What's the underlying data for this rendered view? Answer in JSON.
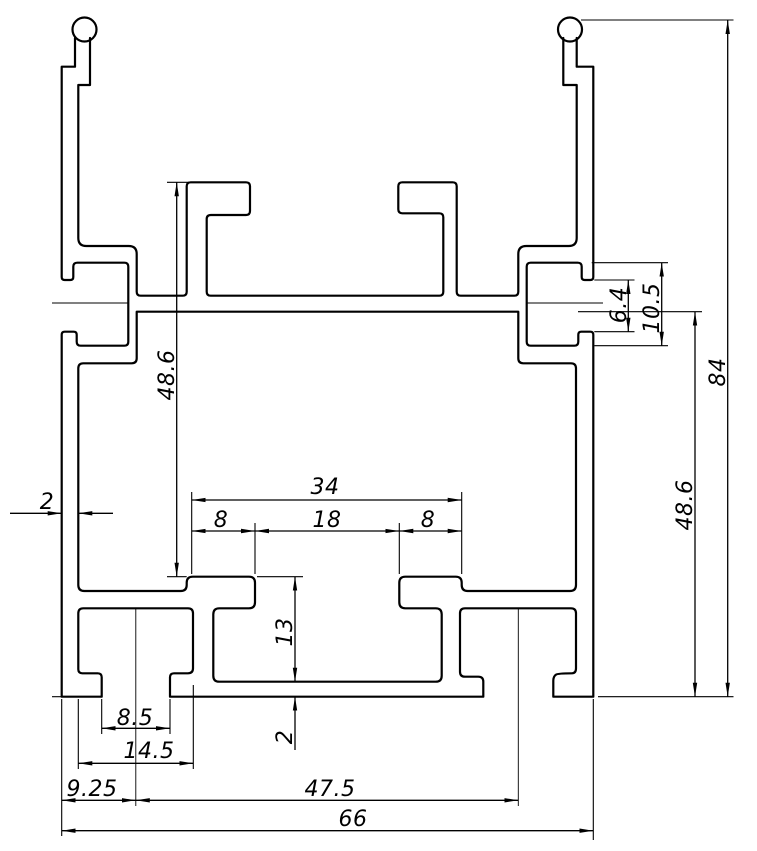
{
  "drawing": {
    "kind": "extrusion-profile-cross-section",
    "background_color": "#ffffff",
    "line_color": "#000000",
    "dims": {
      "overall_height": "84",
      "overall_width": "66",
      "upper_channel_height": "48.6",
      "lower_right_height": "48.6",
      "top_slot_group_width": "34",
      "slot_flange_left": "8",
      "slot_opening": "18",
      "slot_flange_right": "8",
      "wall_thickness": "2",
      "side_mouth_opening": "6.4",
      "side_pocket_depth": "10.5",
      "bottom_channel_depth": "13",
      "bottom_floor_thickness": "2",
      "bottom_slot_inner_width": "8.5",
      "bottom_slot_outer_width": "14.5",
      "bottom_slot_center_offset": "9.25",
      "bottom_centers_span": "47.5",
      "bottom_total_width": "66"
    }
  }
}
